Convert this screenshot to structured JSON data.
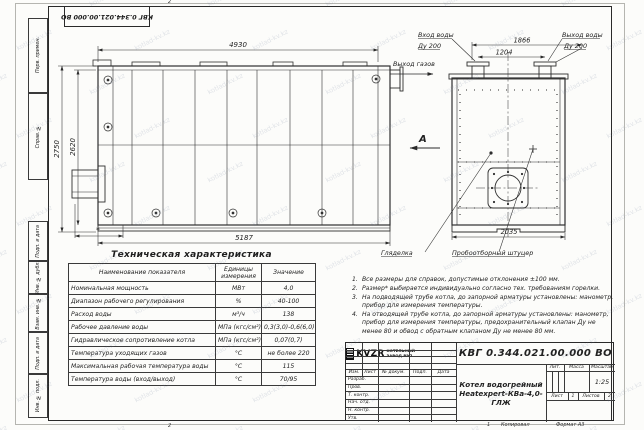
{
  "watermark": {
    "text": "kotlad-kv.kz"
  },
  "frame": {
    "doc_number_rotated": "КВГ 0.344.021.00.000 ВО",
    "fold_mark_top": "2",
    "fold_mark_bottom": "2",
    "copy_mark": "1",
    "copied_label": "Копировал",
    "format_label": "Формат А3",
    "margin_boxes": [
      {
        "label": "Перв. примен."
      },
      {
        "label": "Справ. №"
      },
      {
        "label": "Подп. и дата"
      },
      {
        "label": "Инв. № дубл."
      },
      {
        "label": "Взам. инв. №"
      },
      {
        "label": "Подп. и дата"
      },
      {
        "label": "Инв. № подл."
      }
    ]
  },
  "drawing": {
    "main_view": {
      "dim_top": "4930",
      "dim_left_outer": "2750",
      "dim_left_inner": "2620",
      "dim_bottom": "5187",
      "dim_asterisk": "*"
    },
    "end_view": {
      "dim_flanges": "1866",
      "dim_inner": "1204",
      "dim_width": "2035",
      "label_water_in": "Вход воды",
      "label_water_in_dn": "Ду 200",
      "label_water_out": "Выход воды",
      "label_water_out_dn": "Ду 200",
      "label_gas_out": "Выход газов",
      "view_letter": "А",
      "label_sight_glass": "Гляделка",
      "label_sampling": "Пробоотборный штуцер"
    }
  },
  "spec_table": {
    "title": "Техническая характеристика",
    "headers": [
      "Наименование показателя",
      "Единицы измерения",
      "Значение"
    ],
    "rows": [
      [
        "Номинальная мощность",
        "МВт",
        "4,0"
      ],
      [
        "Диапазон рабочего регулирования",
        "%",
        "40-100"
      ],
      [
        "Расход воды",
        "м³/ч",
        "138"
      ],
      [
        "Рабочее давление воды",
        "МПа (кгс/см²)",
        "0,3(3,0)-0,6(6,0)"
      ],
      [
        "Гидравлическое сопротивление котла",
        "МПа (кгс/см²)",
        "0,07(0,7)"
      ],
      [
        "Температура уходящих газов",
        "°С",
        "не более 220"
      ],
      [
        "Максимальная рабочая температура воды",
        "°С",
        "115"
      ],
      [
        "Температура воды (вход/выход)",
        "°С",
        "70/95"
      ]
    ]
  },
  "notes": [
    {
      "n": "1.",
      "text": "Все размеры для справок, допустимые отклонения ±100 мм."
    },
    {
      "n": "2.",
      "text": "Размер* выбирается индивидуально согласно тех. требованиям горелки."
    },
    {
      "n": "3.",
      "text": "На подводящей трубе котла, до запорной арматуры установлены: манометр, прибор для измерения температуры."
    },
    {
      "n": "4.",
      "text": "На отводящей трубе котла, до запорной арматуры установлены: манометр, прибор для измерения температуры, предохранительный клапан Ду не менее 80 и обвод с обратным клапаном Ду не менее 80 мм."
    }
  ],
  "title_block": {
    "doc_number": "КВГ 0.344.021.00.000 ВО",
    "name_line1": "Котел водогрейный",
    "name_line2": "Heatexpert-КВа-4,0-ГЛЖ",
    "cols": [
      "Изм.",
      "Лист",
      "№ докум.",
      "Подп.",
      "Дата"
    ],
    "rows": [
      "Разраб.",
      "Пров.",
      "Т. контр.",
      "Нач. отд.",
      "Н. контр.",
      "Утв."
    ],
    "lit": "Лит.",
    "mass": "Масса",
    "scale": "Масштаб",
    "scale_value": "1:25",
    "sheet_label": "Лист",
    "sheet_value": "1",
    "sheets_label": "Листов",
    "sheets_value": "2",
    "brand": "KVZR",
    "brand_line1": "КОТЕЛЬНЫЙ",
    "brand_line2": "ЗАВОД РЭП"
  }
}
